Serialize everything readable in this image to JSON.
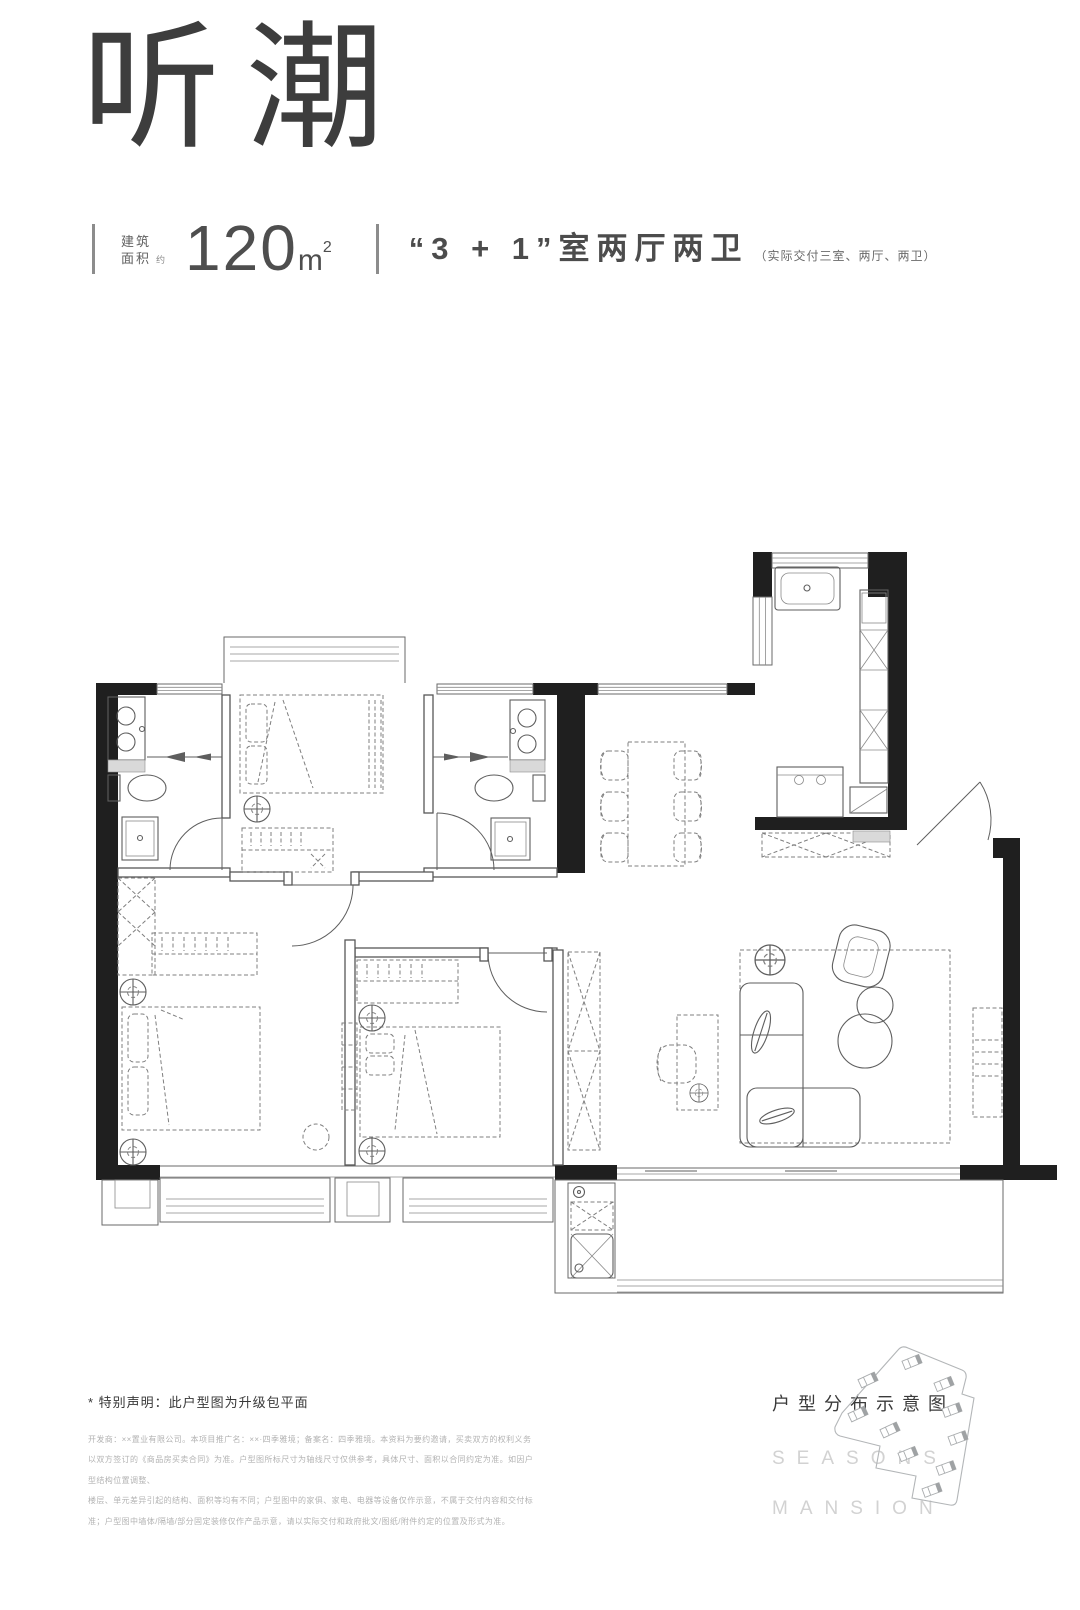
{
  "page": {
    "background": "#ffffff"
  },
  "header": {
    "title": "听潮",
    "area": {
      "label_top": "建筑",
      "label_bottom": "面积",
      "approx": "约",
      "value": "120",
      "unit": "m",
      "unit_sup": "2"
    },
    "layout": {
      "text": "“3 + 1”室两厅两卫",
      "note": "（实际交付三室、两厅、两卫）"
    }
  },
  "floorplan": {
    "type": "apartment-floor-plan",
    "style": {
      "wall_color": "#1f1f1f",
      "line_color": "#6a6a6a",
      "furniture_color": "#7f7f7f"
    }
  },
  "footer": {
    "disclaimer_title": "* 特别声明：此户型图为升级包平面",
    "disclaimer_lines": [
      "开发商：××置业有限公司。本项目推广名：××·四季雅境；备案名：四季雅境。本资料为要约邀请，买卖双方的权利义务",
      "以双方签订的《商品房买卖合同》为准。户型图所标尺寸为轴线尺寸仅供参考，具体尺寸、面积以合同约定为准。如因户型结构位置调整、",
      "楼层、单元差异引起的结构、面积等均有不同；户型图中的家俱、家电、电器等设备仅作示意，不属于交付内容和交付标",
      "准；户型图中墙体/隔墙/部分固定装修仅作产品示意，请以实际交付和政府批文/图纸/附件约定的位置及形式为准。"
    ],
    "sitemap_title": "户型分布示意图",
    "brand_line1": "SEASONS",
    "brand_line2": "MANSION"
  },
  "colors": {
    "ink": "#3d3d3d",
    "wall": "#1f1f1f",
    "line": "#6a6a6a",
    "muted": "#b3b3b3",
    "brand_gray": "#d2d2d2"
  }
}
